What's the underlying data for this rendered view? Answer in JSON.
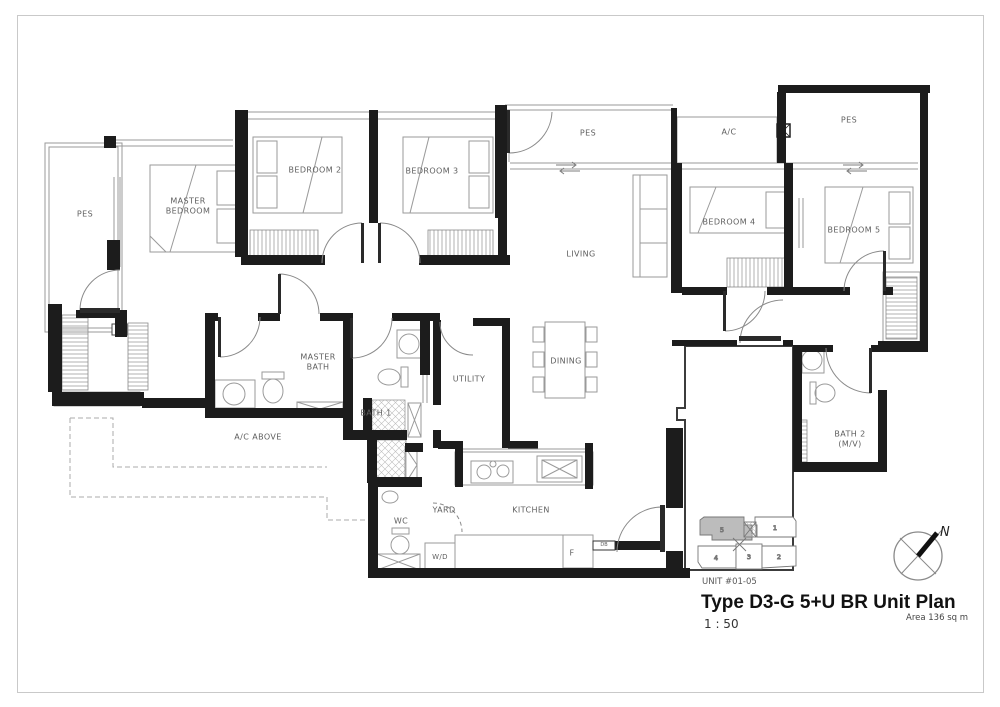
{
  "labels": {
    "pes_left": "PES",
    "master_bedroom": "MASTER BEDROOM",
    "bedroom2": "BEDROOM 2",
    "bedroom3": "BEDROOM 3",
    "pes_top": "PES",
    "ac_top": "A/C",
    "pes_right": "PES",
    "living": "LIVING",
    "bedroom4": "BEDROOM 4",
    "bedroom5": "BEDROOM 5",
    "master_bath": "MASTER BATH",
    "bath1": "BATH 1",
    "ac_above": "A/C ABOVE",
    "utility": "UTILITY",
    "dining": "DINING",
    "wc": "WC",
    "yard": "YARD",
    "kitchen": "KITCHEN",
    "wd": "W/D",
    "fridge": "F",
    "bath2": "BATH 2 (M/V)",
    "db": "DB"
  },
  "title_block": {
    "unit_label": "UNIT #01-05",
    "title": "Type D3-G 5+U BR Unit Plan",
    "scale": "1 : 50",
    "area": "Area 136 sq m"
  },
  "keyplan": {
    "u5": "5",
    "u1": "1",
    "u4": "4",
    "u3": "3",
    "u2": "2"
  },
  "compass": {
    "north": "N"
  },
  "colors": {
    "wall": "#1c1c1c",
    "thin_line": "#9a9a9a",
    "label_text": "#5f5f5f",
    "keyplan_highlight": "#bcbcbc",
    "background": "#ffffff",
    "border": "#c9c9c9"
  }
}
